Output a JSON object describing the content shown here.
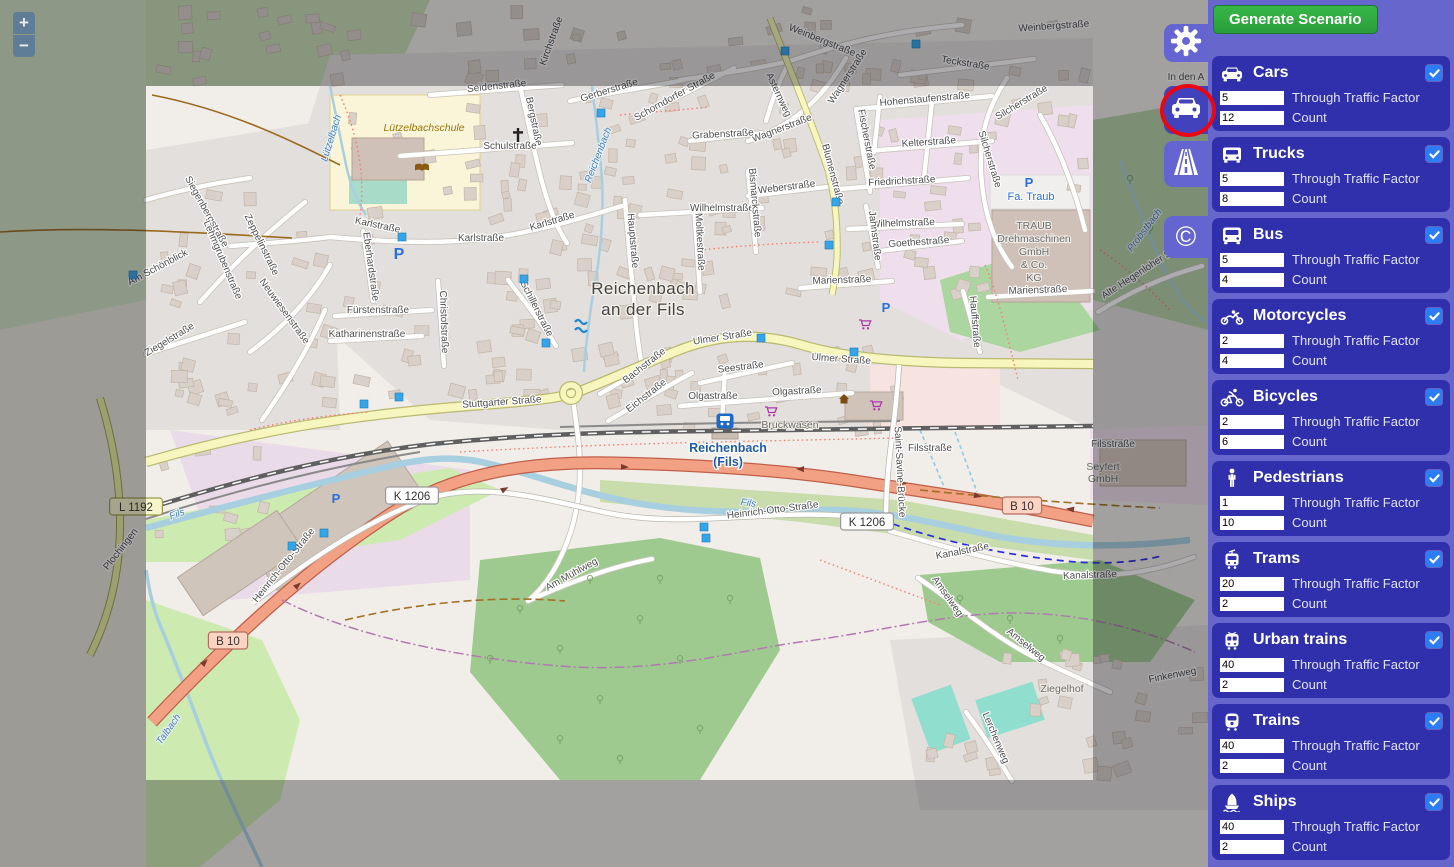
{
  "toolbar": {
    "generate_label": "Generate Scenario"
  },
  "tabs": [
    {
      "icon": "gear-icon",
      "active": false
    },
    {
      "icon": "car-icon",
      "active": true
    },
    {
      "icon": "road-icon",
      "active": false
    },
    {
      "icon": "copyright-icon",
      "active": false,
      "glyph": "©"
    }
  ],
  "labels": {
    "through": "Through Traffic Factor",
    "count": "Count"
  },
  "vehicles": [
    {
      "label": "Cars",
      "icon": "car-icon",
      "checked": true,
      "factor": "5",
      "count": "12"
    },
    {
      "label": "Trucks",
      "icon": "truck-icon",
      "checked": true,
      "factor": "5",
      "count": "8"
    },
    {
      "label": "Bus",
      "icon": "bus-icon",
      "checked": true,
      "factor": "5",
      "count": "4"
    },
    {
      "label": "Motorcycles",
      "icon": "motorcycle-icon",
      "checked": true,
      "factor": "2",
      "count": "4"
    },
    {
      "label": "Bicycles",
      "icon": "bicycle-icon",
      "checked": true,
      "factor": "2",
      "count": "6"
    },
    {
      "label": "Pedestrians",
      "icon": "pedestrian-icon",
      "checked": true,
      "factor": "1",
      "count": "10"
    },
    {
      "label": "Trams",
      "icon": "tram-icon",
      "checked": true,
      "factor": "20",
      "count": "2"
    },
    {
      "label": "Urban trains",
      "icon": "urban-train-icon",
      "checked": true,
      "factor": "40",
      "count": "2"
    },
    {
      "label": "Trains",
      "icon": "train-icon",
      "checked": true,
      "factor": "40",
      "count": "2"
    },
    {
      "label": "Ships",
      "icon": "ship-icon",
      "checked": true,
      "factor": "40",
      "count": "2"
    }
  ],
  "map": {
    "zoom_in": "+",
    "zoom_out": "−",
    "badges": [
      {
        "t": "B 10",
        "x": 228,
        "y": 641,
        "k": "b"
      },
      {
        "t": "B 10",
        "x": 1022,
        "y": 506,
        "k": "b"
      },
      {
        "t": "K 1206",
        "x": 412,
        "y": 496,
        "k": "w"
      },
      {
        "t": "K 1206",
        "x": 867,
        "y": 522,
        "k": "w"
      },
      {
        "t": "L 1192",
        "x": 136,
        "y": 507,
        "k": "y"
      }
    ],
    "labels": [
      {
        "t": "Seidenstraße",
        "x": 497,
        "y": 89,
        "r": -6,
        "c": "s"
      },
      {
        "t": "Bergstraße",
        "x": 531,
        "y": 122,
        "r": 78,
        "c": "s"
      },
      {
        "t": "Gerberstraße",
        "x": 610,
        "y": 93,
        "r": -17,
        "c": "s"
      },
      {
        "t": "Schorndorfer Straße",
        "x": 676,
        "y": 99,
        "r": -29,
        "c": "s"
      },
      {
        "t": "Schulstraße",
        "x": 510,
        "y": 149,
        "r": 0,
        "c": "s"
      },
      {
        "t": "Karlstraße",
        "x": 377,
        "y": 228,
        "r": 12,
        "c": "s"
      },
      {
        "t": "Karlstraße",
        "x": 481,
        "y": 241,
        "r": 0,
        "c": "s"
      },
      {
        "t": "Karlstraße",
        "x": 553,
        "y": 224,
        "r": -17,
        "c": "s"
      },
      {
        "t": "Eberhardstraße",
        "x": 368,
        "y": 267,
        "r": 82,
        "c": "s"
      },
      {
        "t": "Fürstenstraße",
        "x": 378,
        "y": 313,
        "r": 0,
        "c": "s"
      },
      {
        "t": "Katharinenstraße",
        "x": 367,
        "y": 337,
        "r": 0,
        "c": "s"
      },
      {
        "t": "Christofstraße",
        "x": 441,
        "y": 322,
        "r": 88,
        "c": "s"
      },
      {
        "t": "Schillerstraße",
        "x": 534,
        "y": 310,
        "r": 63,
        "c": "s"
      },
      {
        "t": "Stuttgarter Straße",
        "x": 502,
        "y": 405,
        "r": -4,
        "c": "s"
      },
      {
        "t": "Ulmer Straße",
        "x": 723,
        "y": 340,
        "r": -9,
        "c": "s"
      },
      {
        "t": "Ulmer Straße",
        "x": 841,
        "y": 362,
        "r": 4,
        "c": "s"
      },
      {
        "t": "Bachstraße",
        "x": 646,
        "y": 368,
        "r": -38,
        "c": "s"
      },
      {
        "t": "Eichstraße",
        "x": 648,
        "y": 398,
        "r": -38,
        "c": "s"
      },
      {
        "t": "Seestraße",
        "x": 741,
        "y": 370,
        "r": -7,
        "c": "s"
      },
      {
        "t": "Olgastraße",
        "x": 713,
        "y": 399,
        "r": 0,
        "c": "s"
      },
      {
        "t": "Olgastraße",
        "x": 797,
        "y": 394,
        "r": -3,
        "c": "s"
      },
      {
        "t": "Hauptstraße",
        "x": 630,
        "y": 241,
        "r": 85,
        "c": "s"
      },
      {
        "t": "Moltkestraße",
        "x": 697,
        "y": 242,
        "r": 87,
        "c": "s"
      },
      {
        "t": "Wilhelmstraße",
        "x": 722,
        "y": 211,
        "r": 0,
        "c": "s"
      },
      {
        "t": "Wilhelmstraße",
        "x": 903,
        "y": 226,
        "r": -2,
        "c": "s"
      },
      {
        "t": "Bismarckstraße",
        "x": 752,
        "y": 203,
        "r": 85,
        "c": "s"
      },
      {
        "t": "Weberstraße",
        "x": 787,
        "y": 190,
        "r": -7,
        "c": "s"
      },
      {
        "t": "Friedrichstraße",
        "x": 902,
        "y": 184,
        "r": -3,
        "c": "s"
      },
      {
        "t": "Blumenstraße",
        "x": 830,
        "y": 175,
        "r": 75,
        "c": "s"
      },
      {
        "t": "Wagnerstraße",
        "x": 783,
        "y": 131,
        "r": -21,
        "c": "s"
      },
      {
        "t": "Wagnerstraße",
        "x": 850,
        "y": 78,
        "r": -57,
        "c": "s"
      },
      {
        "t": "Fischerstraße",
        "x": 864,
        "y": 140,
        "r": 79,
        "c": "s"
      },
      {
        "t": "Kelterstraße",
        "x": 929,
        "y": 145,
        "r": -4,
        "c": "s"
      },
      {
        "t": "Hohenstaufenstraße",
        "x": 925,
        "y": 102,
        "r": -5,
        "c": "s"
      },
      {
        "t": "Grabenstraße",
        "x": 723,
        "y": 137,
        "r": -3,
        "c": "s"
      },
      {
        "t": "Silcherstraße",
        "x": 1023,
        "y": 105,
        "r": -31,
        "c": "s"
      },
      {
        "t": "Silcherstraße",
        "x": 987,
        "y": 160,
        "r": 73,
        "c": "s"
      },
      {
        "t": "Goethestraße",
        "x": 919,
        "y": 245,
        "r": -4,
        "c": "s"
      },
      {
        "t": "Jahnstraße",
        "x": 872,
        "y": 236,
        "r": 83,
        "c": "s"
      },
      {
        "t": "Marienstraße",
        "x": 842,
        "y": 283,
        "r": -2,
        "c": "s"
      },
      {
        "t": "Marienstraße",
        "x": 1038,
        "y": 293,
        "r": -2,
        "c": "s"
      },
      {
        "t": "Hauffstraße",
        "x": 972,
        "y": 322,
        "r": 85,
        "c": "s"
      },
      {
        "t": "Weinbergstraße",
        "x": 821,
        "y": 43,
        "r": 22,
        "c": "s"
      },
      {
        "t": "Weinbergstraße",
        "x": 1054,
        "y": 29,
        "r": -4,
        "c": "s"
      },
      {
        "t": "Teckstraße",
        "x": 965,
        "y": 66,
        "r": 9,
        "c": "s"
      },
      {
        "t": "Asternweg",
        "x": 776,
        "y": 96,
        "r": 65,
        "c": "s"
      },
      {
        "t": "Siegenbergstraße",
        "x": 204,
        "y": 213,
        "r": 61,
        "c": "s"
      },
      {
        "t": "Lehmgrubenstraße",
        "x": 220,
        "y": 261,
        "r": 67,
        "c": "s"
      },
      {
        "t": "Zeppelinstraße",
        "x": 259,
        "y": 246,
        "r": 64,
        "c": "s"
      },
      {
        "t": "Neuwiesenstraße",
        "x": 282,
        "y": 313,
        "r": 54,
        "c": "s"
      },
      {
        "t": "Am Schönblick",
        "x": 159,
        "y": 270,
        "r": -28,
        "c": "s"
      },
      {
        "t": "Ziegelstraße",
        "x": 171,
        "y": 342,
        "r": -31,
        "c": "s"
      },
      {
        "t": "Heinrich-Otto-Straße",
        "x": 286,
        "y": 567,
        "r": -51,
        "c": "s"
      },
      {
        "t": "Heinrich-Otto-Straße",
        "x": 773,
        "y": 513,
        "r": -7,
        "c": "s"
      },
      {
        "t": "Am Mühlweg",
        "x": 573,
        "y": 577,
        "r": -29,
        "c": "s"
      },
      {
        "t": "Kanalstraße",
        "x": 963,
        "y": 554,
        "r": -11,
        "c": "s"
      },
      {
        "t": "Kanalstraße",
        "x": 1090,
        "y": 578,
        "r": -2,
        "c": "s"
      },
      {
        "t": "Amselweg",
        "x": 945,
        "y": 598,
        "r": 55,
        "c": "s"
      },
      {
        "t": "Amselweg",
        "x": 1024,
        "y": 647,
        "r": 39,
        "c": "s"
      },
      {
        "t": "Lerchenweg",
        "x": 993,
        "y": 739,
        "r": 67,
        "c": "s"
      },
      {
        "t": "Finkenweg",
        "x": 1173,
        "y": 678,
        "r": -11,
        "c": "s"
      },
      {
        "t": "Filsstraße",
        "x": 930,
        "y": 451,
        "r": 0,
        "c": "s"
      },
      {
        "t": "Filsstraße",
        "x": 1113,
        "y": 447,
        "r": 0,
        "c": "s"
      },
      {
        "t": "Saint-Savine-Brücke",
        "x": 897,
        "y": 472,
        "r": 87,
        "c": "s"
      },
      {
        "t": "In den A",
        "x": 1186,
        "y": 80,
        "r": 0,
        "c": "s"
      },
      {
        "t": "Kirchstraße",
        "x": 554,
        "y": 42,
        "r": -70,
        "c": "s"
      },
      {
        "t": "Plochingen",
        "x": 123,
        "y": 551,
        "r": -52,
        "c": "s"
      },
      {
        "t": "Alte Hegenloher S",
        "x": 1138,
        "y": 277,
        "r": -33,
        "c": "s"
      },
      {
        "t": "Fils",
        "x": 178,
        "y": 517,
        "r": -21,
        "c": "w"
      },
      {
        "t": "Fils",
        "x": 748,
        "y": 506,
        "r": 7,
        "c": "w"
      },
      {
        "t": "Talbach",
        "x": 171,
        "y": 731,
        "r": -55,
        "c": "w"
      },
      {
        "t": "Lützelbach",
        "x": 334,
        "y": 139,
        "r": -73,
        "c": "w"
      },
      {
        "t": "Reichenbach",
        "x": 601,
        "y": 156,
        "r": -69,
        "c": "w"
      },
      {
        "t": "Probstbach",
        "x": 1147,
        "y": 232,
        "r": -53,
        "c": "w"
      },
      {
        "t": "Reichenbach",
        "x": 643,
        "y": 294,
        "r": 0,
        "c": "p"
      },
      {
        "t": "an der Fils",
        "x": 643,
        "y": 315,
        "r": 0,
        "c": "p"
      },
      {
        "t": "Reichenbach",
        "x": 728,
        "y": 452,
        "r": 0,
        "c": "n"
      },
      {
        "t": "(Fils)",
        "x": 728,
        "y": 466,
        "r": 0,
        "c": "n"
      },
      {
        "t": "Bruckwasen",
        "x": 790,
        "y": 428,
        "r": 0,
        "c": "o"
      },
      {
        "t": "Ziegelhof",
        "x": 1062,
        "y": 692,
        "r": 0,
        "c": "o",
        "fs": "13.5"
      },
      {
        "t": "Seyfert",
        "x": 1103,
        "y": 470,
        "r": 0,
        "c": "o"
      },
      {
        "t": "GmbH",
        "x": 1103,
        "y": 482,
        "r": 0,
        "c": "o"
      },
      {
        "t": "TRAUB",
        "x": 1034,
        "y": 229,
        "r": 0,
        "c": "o"
      },
      {
        "t": "Drehmaschinen",
        "x": 1034,
        "y": 242,
        "r": 0,
        "c": "o"
      },
      {
        "t": "GmbH",
        "x": 1034,
        "y": 255,
        "r": 0,
        "c": "o"
      },
      {
        "t": "& Co.",
        "x": 1034,
        "y": 268,
        "r": 0,
        "c": "o"
      },
      {
        "t": "KG",
        "x": 1034,
        "y": 281,
        "r": 0,
        "c": "o"
      },
      {
        "t": "Lützelbachschule",
        "x": 424,
        "y": 131,
        "r": 0,
        "c": "e"
      },
      {
        "t": "Fa. Traub",
        "x": 1031,
        "y": 200,
        "r": 0,
        "c": "f"
      }
    ],
    "parking": [
      [
        399,
        259,
        16
      ],
      [
        886,
        312,
        13
      ],
      [
        1029,
        187,
        13
      ],
      [
        336,
        503,
        13
      ]
    ],
    "carts": [
      [
        771,
        412
      ],
      [
        876,
        406
      ],
      [
        865,
        325
      ]
    ],
    "markers": [
      [
        785,
        51
      ],
      [
        916,
        44
      ],
      [
        402,
        237
      ],
      [
        524,
        279
      ],
      [
        546,
        343
      ],
      [
        364,
        404
      ],
      [
        399,
        397
      ],
      [
        761,
        338
      ],
      [
        854,
        352
      ],
      [
        836,
        202
      ],
      [
        829,
        245
      ],
      [
        133,
        275
      ],
      [
        292,
        546
      ],
      [
        324,
        533
      ],
      [
        704,
        527
      ],
      [
        706,
        538
      ],
      [
        601,
        113
      ]
    ],
    "station": [
      725,
      421
    ]
  },
  "colors": {
    "panel": "#6666cc",
    "card": "#3030ad",
    "checkbox": "#2b7cf5",
    "generate": "#2ea83c",
    "selection_ring": "#e90713",
    "trunk_road": "#f2a184",
    "primary_road": "#f6f6be",
    "water": "#a8cfdf"
  }
}
